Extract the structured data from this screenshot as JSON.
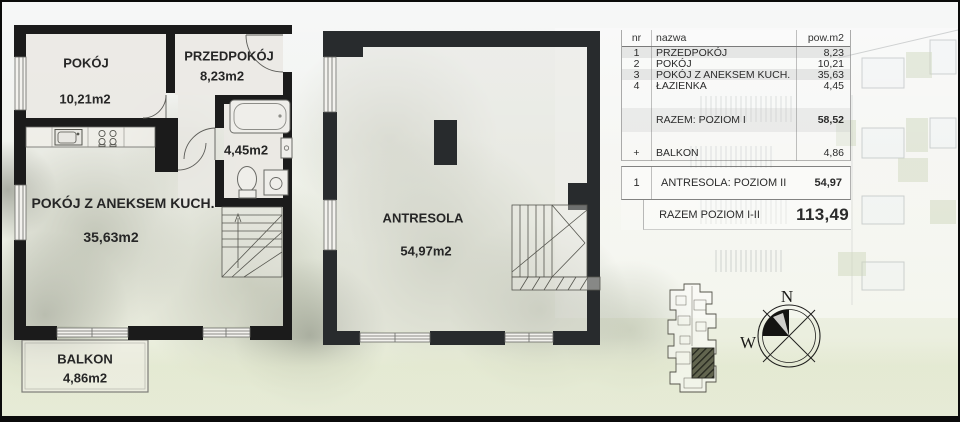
{
  "plan_level1": {
    "rooms": {
      "pokoj": {
        "name": "POKÓJ",
        "area": "10,21m2"
      },
      "przedpokoj": {
        "name": "PRZEDPOKÓJ",
        "area": "8,23m2"
      },
      "lazienka": {
        "area": "4,45m2"
      },
      "aneks": {
        "name": "POKÓJ Z ANEKSEM KUCH.",
        "area": "35,63m2"
      },
      "balkon": {
        "name": "BALKON",
        "area": "4,86m2"
      }
    }
  },
  "plan_level2": {
    "rooms": {
      "antresola": {
        "name": "ANTRESOLA",
        "area": "54,97m2"
      }
    }
  },
  "area_table": {
    "headers": {
      "nr": "nr",
      "nazwa": "nazwa",
      "pow": "pow.m2"
    },
    "rows": [
      {
        "nr": "1",
        "nazwa": "PRZEDPOKÓJ",
        "pow": "8,23"
      },
      {
        "nr": "2",
        "nazwa": "POKÓJ",
        "pow": "10,21"
      },
      {
        "nr": "3",
        "nazwa": "POKÓJ Z ANEKSEM KUCH.",
        "pow": "35,63"
      },
      {
        "nr": "4",
        "nazwa": "ŁAZIENKA",
        "pow": "4,45"
      }
    ],
    "subtotal_level1": {
      "nazwa": "RAZEM: POZIOM I",
      "pow": "58,52"
    },
    "balcony_row": {
      "nr": "+",
      "nazwa": "BALKON",
      "pow": "4,86"
    },
    "level2_row": {
      "nr": "1",
      "nazwa": "ANTRESOLA: POZIOM II",
      "pow": "54,97"
    },
    "total_row": {
      "nazwa": "RAZEM POZIOM I-II",
      "pow": "113,49"
    }
  },
  "compass": {
    "north": "N",
    "west": "W"
  },
  "colors": {
    "wall_level1": "#1b1b1b",
    "wall_level2": "#282b2d",
    "accent_green": "#b9c6a4"
  }
}
